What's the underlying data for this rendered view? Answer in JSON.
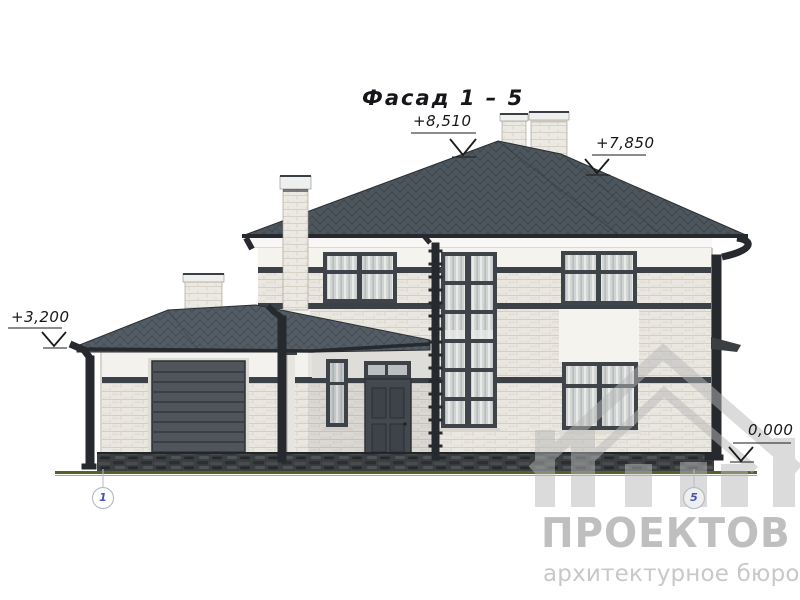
{
  "title": "Фасад 1 – 5",
  "annotations": {
    "elevation_marks": [
      {
        "id": "roof-peak",
        "label": "+8,510"
      },
      {
        "id": "roof-eave",
        "label": "+7,850"
      },
      {
        "id": "wing-eave",
        "label": "+3,200"
      },
      {
        "id": "ground",
        "label": "0,000"
      }
    ],
    "axis_markers": [
      {
        "id": "axis-1",
        "label": "1"
      },
      {
        "id": "axis-5",
        "label": "5"
      }
    ]
  },
  "watermark": {
    "logo": "house-logo",
    "brand": "ПРОЕКТОВ",
    "tagline": "архитектурное бюро"
  },
  "colors": {
    "roof_shingles": "#4e565e",
    "wing_roof": "#545d66",
    "brick_wall": "#eae7e0",
    "stucco": "#f4f3ee",
    "trim_band": "#3c4147",
    "window_frame": "#3e444a",
    "garage_door": "#50555b",
    "entry_door": "#464b51",
    "stone_base": "#3c3f42",
    "ground_line": "#5a6128",
    "annotation_ink": "#1a1a1a",
    "axis_number": "#4355ae",
    "watermark_gray": "#c0c0c0"
  }
}
